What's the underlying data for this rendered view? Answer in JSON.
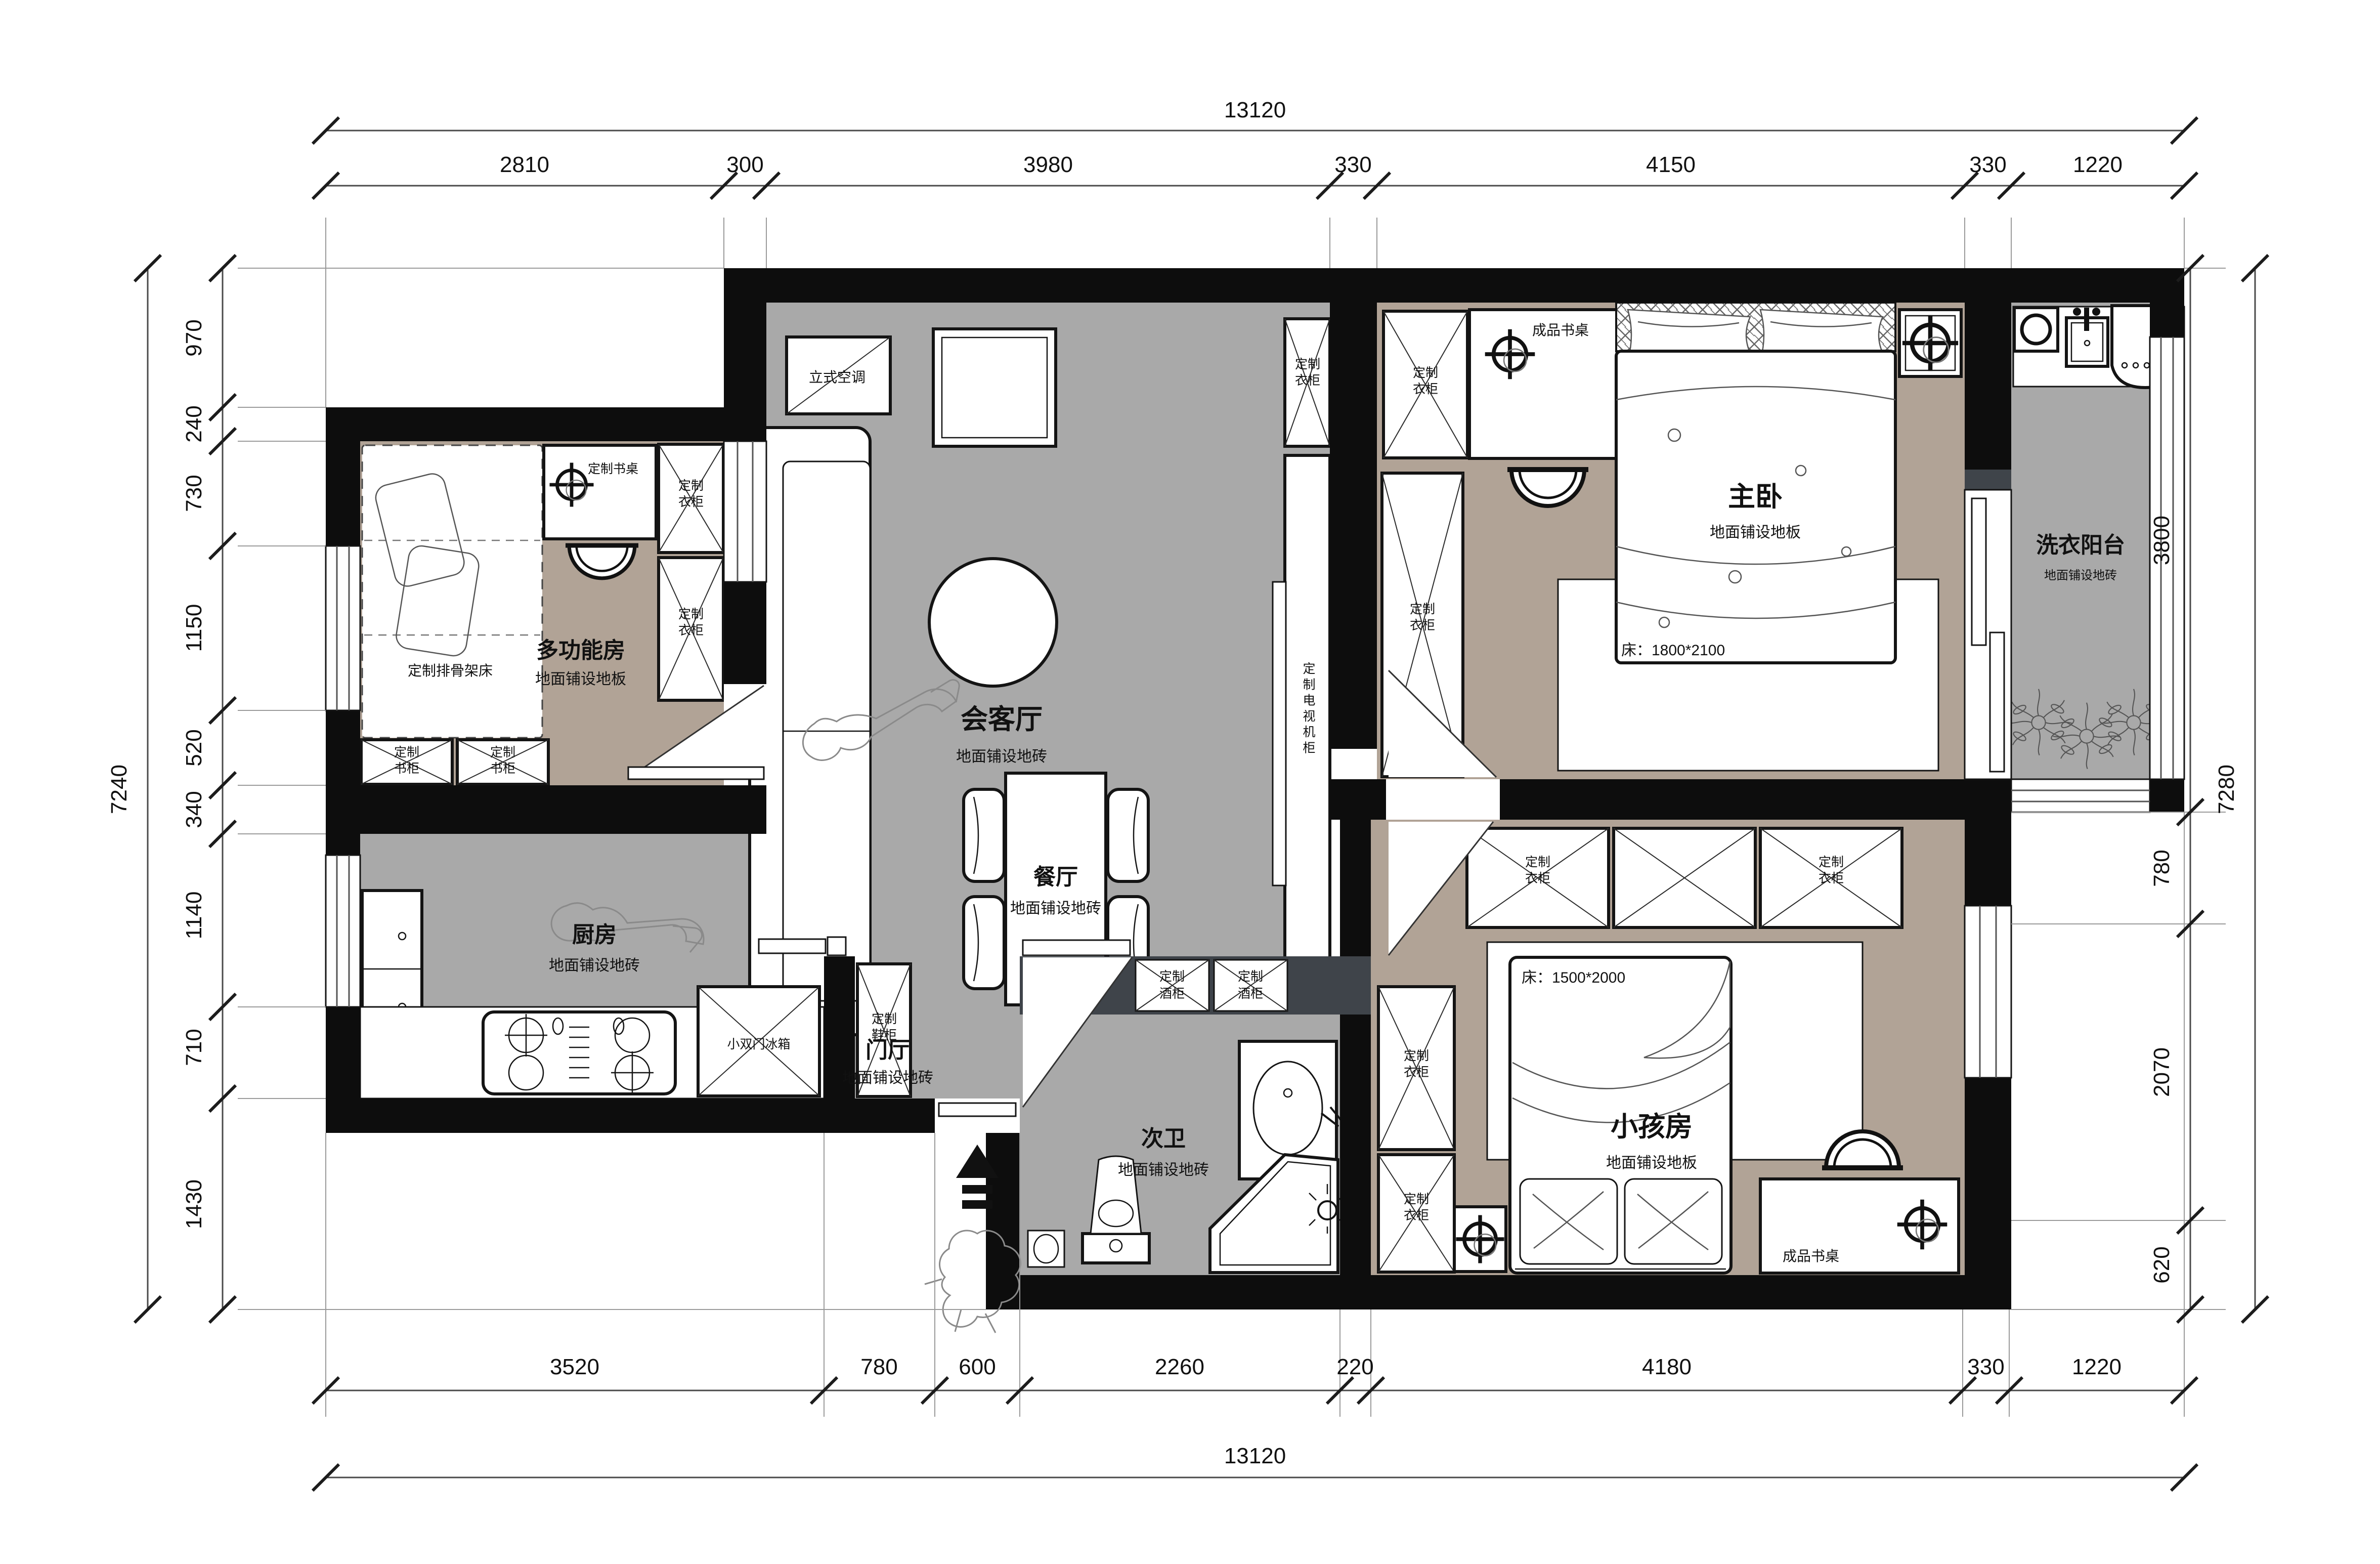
{
  "dimensions": {
    "top": {
      "total": "13120",
      "segments": [
        "2810",
        "300",
        "3980",
        "330",
        "4150",
        "330",
        "1220"
      ]
    },
    "bottom": {
      "total": "13120",
      "segments": [
        "3520",
        "780",
        "600",
        "2260",
        "220",
        "4180",
        "330",
        "1220"
      ]
    },
    "left": {
      "total": "7240",
      "segments": [
        "970",
        "240",
        "730",
        "1150",
        "520",
        "340",
        "1140",
        "710",
        "1430"
      ]
    },
    "right": {
      "total": "7280",
      "segments": [
        "3800",
        "780",
        "2070",
        "620"
      ]
    }
  },
  "rooms": {
    "living": {
      "name": "会客厅",
      "floor": "地面铺设地砖"
    },
    "dining": {
      "name": "餐厅",
      "floor": "地面铺设地砖"
    },
    "hall": {
      "name": "门厅",
      "floor": "地面铺设地砖"
    },
    "bath2": {
      "name": "次卫",
      "floor": "地面铺设地砖"
    },
    "kitchen": {
      "name": "厨房",
      "floor": "地面铺设地砖"
    },
    "multi": {
      "name": "多功能房",
      "floor": "地面铺设地板"
    },
    "master": {
      "name": "主卧",
      "floor": "地面铺设地板"
    },
    "kids": {
      "name": "小孩房",
      "floor": "地面铺设地板"
    },
    "laundry": {
      "name": "洗衣阳台",
      "floor": "地面铺设地砖"
    }
  },
  "labels": {
    "ac": "立式空调",
    "custom_desk": "定制书桌",
    "finished_desk": "成品书桌",
    "custom_bed": "定制排骨架床",
    "tv_cabinet": "定制电视机柜",
    "fridge": "小双门冰箱",
    "wardrobe": [
      "定制",
      "衣柜"
    ],
    "bookcase": [
      "定制",
      "书柜"
    ],
    "wine": [
      "定制",
      "酒柜"
    ],
    "shoe": [
      "定制",
      "鞋柜"
    ],
    "master_bed_size": "床：1800*2100",
    "kids_bed_size": "床：1500*2000"
  },
  "colors": {
    "wall": "#0d0d0d",
    "floor_tile": "#a9a9a9",
    "floor_wood": "#b1a396",
    "wine_wall": "#3f444a"
  }
}
